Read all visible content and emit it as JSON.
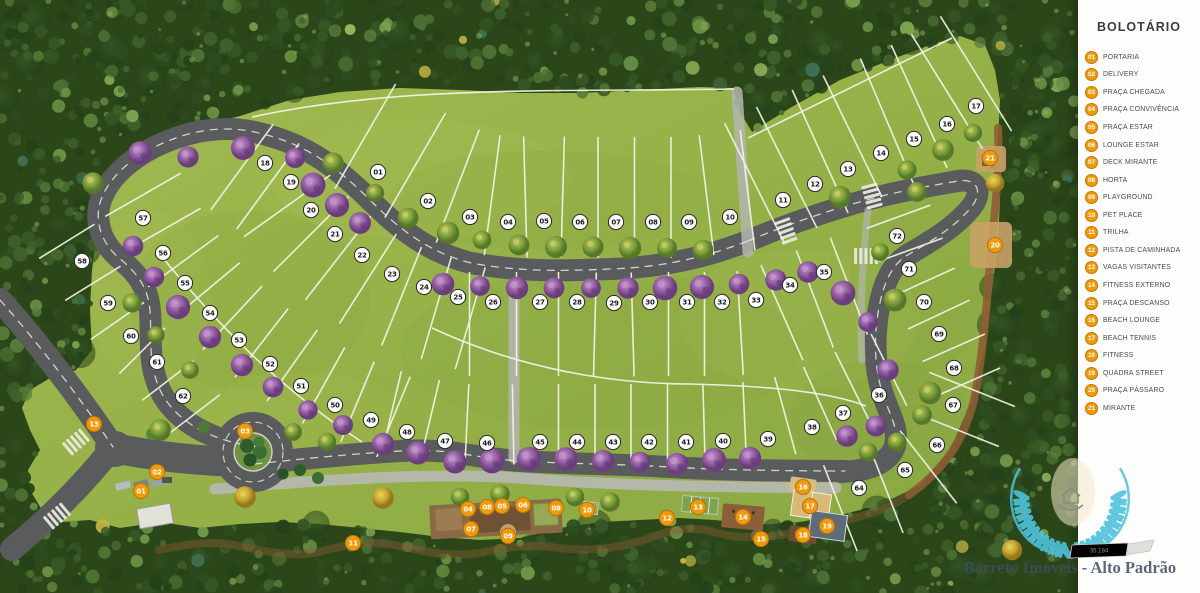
{
  "legend": {
    "title": "BOLOTÁRIO",
    "items": [
      {
        "n": "01",
        "label": "PORTARIA"
      },
      {
        "n": "02",
        "label": "DELIVERY"
      },
      {
        "n": "03",
        "label": "PRAÇA CHEGADA"
      },
      {
        "n": "04",
        "label": "PRAÇA CONVIVÊNCIA"
      },
      {
        "n": "05",
        "label": "PRAÇA ESTAR"
      },
      {
        "n": "06",
        "label": "LOUNGE ESTAR"
      },
      {
        "n": "07",
        "label": "DECK MIRANTE"
      },
      {
        "n": "08",
        "label": "HORTA"
      },
      {
        "n": "09",
        "label": "PLAYGROUND"
      },
      {
        "n": "10",
        "label": "PET PLACE"
      },
      {
        "n": "11",
        "label": "TRILHA"
      },
      {
        "n": "12",
        "label": "PISTA DE CAMINHADA"
      },
      {
        "n": "13",
        "label": "VAGAS VISITANTES"
      },
      {
        "n": "14",
        "label": "FITNESS EXTERNO"
      },
      {
        "n": "15",
        "label": "PRAÇA DESCANSO"
      },
      {
        "n": "16",
        "label": "BEACH LOUNGE"
      },
      {
        "n": "17",
        "label": "BEACH TENNIS"
      },
      {
        "n": "18",
        "label": "FITNESS"
      },
      {
        "n": "19",
        "label": "QUADRA STREET"
      },
      {
        "n": "20",
        "label": "PRAÇA PÁSSARO"
      },
      {
        "n": "21",
        "label": "MIRANTE"
      }
    ]
  },
  "map": {
    "colors": {
      "amenity_orange": "#ED9A0D",
      "lot_circle": "#FDFDFD",
      "road": "#5A5B5D",
      "field": "#9AB44B",
      "forest": "#2C4A1D",
      "trail": "#8A5A33"
    },
    "lot_markers": [
      {
        "n": "01",
        "x": 378,
        "y": 172
      },
      {
        "n": "02",
        "x": 428,
        "y": 201
      },
      {
        "n": "03",
        "x": 470,
        "y": 217
      },
      {
        "n": "04",
        "x": 508,
        "y": 222
      },
      {
        "n": "05",
        "x": 544,
        "y": 221
      },
      {
        "n": "06",
        "x": 580,
        "y": 222
      },
      {
        "n": "07",
        "x": 616,
        "y": 222
      },
      {
        "n": "08",
        "x": 653,
        "y": 222
      },
      {
        "n": "09",
        "x": 689,
        "y": 222
      },
      {
        "n": "10",
        "x": 730,
        "y": 217
      },
      {
        "n": "11",
        "x": 783,
        "y": 200
      },
      {
        "n": "12",
        "x": 815,
        "y": 184
      },
      {
        "n": "13",
        "x": 848,
        "y": 169
      },
      {
        "n": "14",
        "x": 881,
        "y": 153
      },
      {
        "n": "15",
        "x": 914,
        "y": 139
      },
      {
        "n": "16",
        "x": 947,
        "y": 124
      },
      {
        "n": "17",
        "x": 976,
        "y": 106
      },
      {
        "n": "18",
        "x": 265,
        "y": 163
      },
      {
        "n": "19",
        "x": 291,
        "y": 182
      },
      {
        "n": "20",
        "x": 311,
        "y": 210
      },
      {
        "n": "21",
        "x": 335,
        "y": 234
      },
      {
        "n": "22",
        "x": 362,
        "y": 255
      },
      {
        "n": "23",
        "x": 392,
        "y": 274
      },
      {
        "n": "24",
        "x": 424,
        "y": 287
      },
      {
        "n": "25",
        "x": 458,
        "y": 297
      },
      {
        "n": "26",
        "x": 493,
        "y": 302
      },
      {
        "n": "27",
        "x": 540,
        "y": 302
      },
      {
        "n": "28",
        "x": 577,
        "y": 302
      },
      {
        "n": "29",
        "x": 614,
        "y": 303
      },
      {
        "n": "30",
        "x": 650,
        "y": 302
      },
      {
        "n": "31",
        "x": 687,
        "y": 302
      },
      {
        "n": "32",
        "x": 722,
        "y": 302
      },
      {
        "n": "33",
        "x": 756,
        "y": 300
      },
      {
        "n": "34",
        "x": 790,
        "y": 285
      },
      {
        "n": "35",
        "x": 824,
        "y": 272
      },
      {
        "n": "36",
        "x": 879,
        "y": 395
      },
      {
        "n": "37",
        "x": 843,
        "y": 413
      },
      {
        "n": "38",
        "x": 812,
        "y": 427
      },
      {
        "n": "39",
        "x": 768,
        "y": 439
      },
      {
        "n": "40",
        "x": 723,
        "y": 441
      },
      {
        "n": "41",
        "x": 686,
        "y": 442
      },
      {
        "n": "42",
        "x": 649,
        "y": 442
      },
      {
        "n": "43",
        "x": 613,
        "y": 442
      },
      {
        "n": "44",
        "x": 577,
        "y": 442
      },
      {
        "n": "45",
        "x": 540,
        "y": 442
      },
      {
        "n": "46",
        "x": 487,
        "y": 443
      },
      {
        "n": "47",
        "x": 445,
        "y": 441
      },
      {
        "n": "48",
        "x": 407,
        "y": 432
      },
      {
        "n": "49",
        "x": 371,
        "y": 420
      },
      {
        "n": "50",
        "x": 335,
        "y": 405
      },
      {
        "n": "51",
        "x": 301,
        "y": 386
      },
      {
        "n": "52",
        "x": 270,
        "y": 364
      },
      {
        "n": "53",
        "x": 239,
        "y": 340
      },
      {
        "n": "54",
        "x": 210,
        "y": 313
      },
      {
        "n": "55",
        "x": 185,
        "y": 283
      },
      {
        "n": "56",
        "x": 163,
        "y": 253
      },
      {
        "n": "57",
        "x": 143,
        "y": 218
      },
      {
        "n": "58",
        "x": 82,
        "y": 261
      },
      {
        "n": "59",
        "x": 108,
        "y": 303
      },
      {
        "n": "60",
        "x": 131,
        "y": 336
      },
      {
        "n": "61",
        "x": 157,
        "y": 362
      },
      {
        "n": "62",
        "x": 183,
        "y": 396
      },
      {
        "n": "64",
        "x": 859,
        "y": 488
      },
      {
        "n": "65",
        "x": 905,
        "y": 470
      },
      {
        "n": "66",
        "x": 937,
        "y": 445
      },
      {
        "n": "67",
        "x": 953,
        "y": 405
      },
      {
        "n": "68",
        "x": 954,
        "y": 368
      },
      {
        "n": "69",
        "x": 939,
        "y": 334
      },
      {
        "n": "70",
        "x": 924,
        "y": 302
      },
      {
        "n": "71",
        "x": 909,
        "y": 269
      },
      {
        "n": "72",
        "x": 897,
        "y": 236
      }
    ],
    "amenity_markers": [
      {
        "n": "01",
        "x": 141,
        "y": 491
      },
      {
        "n": "02",
        "x": 157,
        "y": 472
      },
      {
        "n": "03",
        "x": 245,
        "y": 431
      },
      {
        "n": "04",
        "x": 468,
        "y": 509
      },
      {
        "n": "05",
        "x": 502,
        "y": 506
      },
      {
        "n": "06",
        "x": 523,
        "y": 505
      },
      {
        "n": "07",
        "x": 471,
        "y": 529
      },
      {
        "n": "08",
        "x": 487,
        "y": 507
      },
      {
        "n": "08",
        "x": 556,
        "y": 508
      },
      {
        "n": "09",
        "x": 508,
        "y": 536
      },
      {
        "n": "10",
        "x": 587,
        "y": 510
      },
      {
        "n": "11",
        "x": 353,
        "y": 543
      },
      {
        "n": "12",
        "x": 667,
        "y": 518
      },
      {
        "n": "13",
        "x": 94,
        "y": 424
      },
      {
        "n": "13",
        "x": 698,
        "y": 507
      },
      {
        "n": "14",
        "x": 743,
        "y": 517
      },
      {
        "n": "15",
        "x": 761,
        "y": 539
      },
      {
        "n": "16",
        "x": 803,
        "y": 487
      },
      {
        "n": "17",
        "x": 810,
        "y": 506
      },
      {
        "n": "18",
        "x": 803,
        "y": 535
      },
      {
        "n": "19",
        "x": 827,
        "y": 526
      },
      {
        "n": "20",
        "x": 995,
        "y": 245
      },
      {
        "n": "21",
        "x": 990,
        "y": 158
      }
    ]
  },
  "watermark": {
    "badge": "35.194",
    "caption": "Barreto Imóveis - Alto Padrão",
    "teal": "#4FC1DC",
    "text_color": "#3E4E62"
  }
}
